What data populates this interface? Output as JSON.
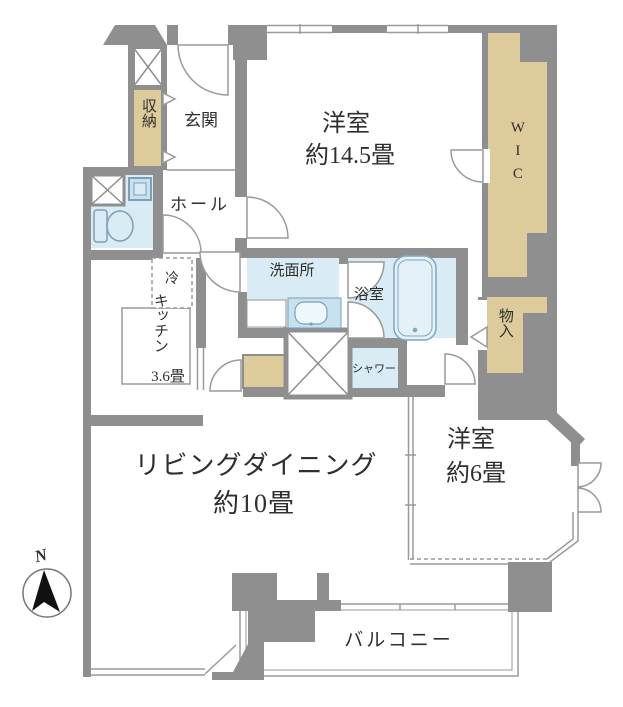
{
  "title": "apartment-floor-plan",
  "colors": {
    "wall": "#8f8f8f",
    "thin_line": "#9a9a9a",
    "closet_tan": "#ddcb9b",
    "wet_area_blue": "#d9ebf4",
    "sink_blue": "#c6e2f0",
    "text": "#2f2f2f"
  },
  "rooms": {
    "bedroom1": {
      "name": "洋室",
      "size": "約14.5畳"
    },
    "living": {
      "name": "リビングダイニング",
      "size": "約10畳"
    },
    "bedroom2": {
      "name": "洋室",
      "size": "約6畳"
    },
    "kitchen": {
      "name": "キッチン",
      "size": "3.6畳"
    },
    "entrance": {
      "name": "玄関"
    },
    "hall": {
      "name": "ホール"
    },
    "washroom": {
      "name": "洗面所"
    },
    "bathroom": {
      "name": "浴室"
    },
    "shower": {
      "name": "シャワー"
    },
    "wic": {
      "name": "WIC"
    },
    "storage_entry": {
      "name": "収納"
    },
    "storage_side": {
      "name": "物入"
    },
    "balcony": {
      "name": "バルコニー"
    },
    "fridge": {
      "name": "冷"
    }
  },
  "compass": {
    "label": "N"
  }
}
